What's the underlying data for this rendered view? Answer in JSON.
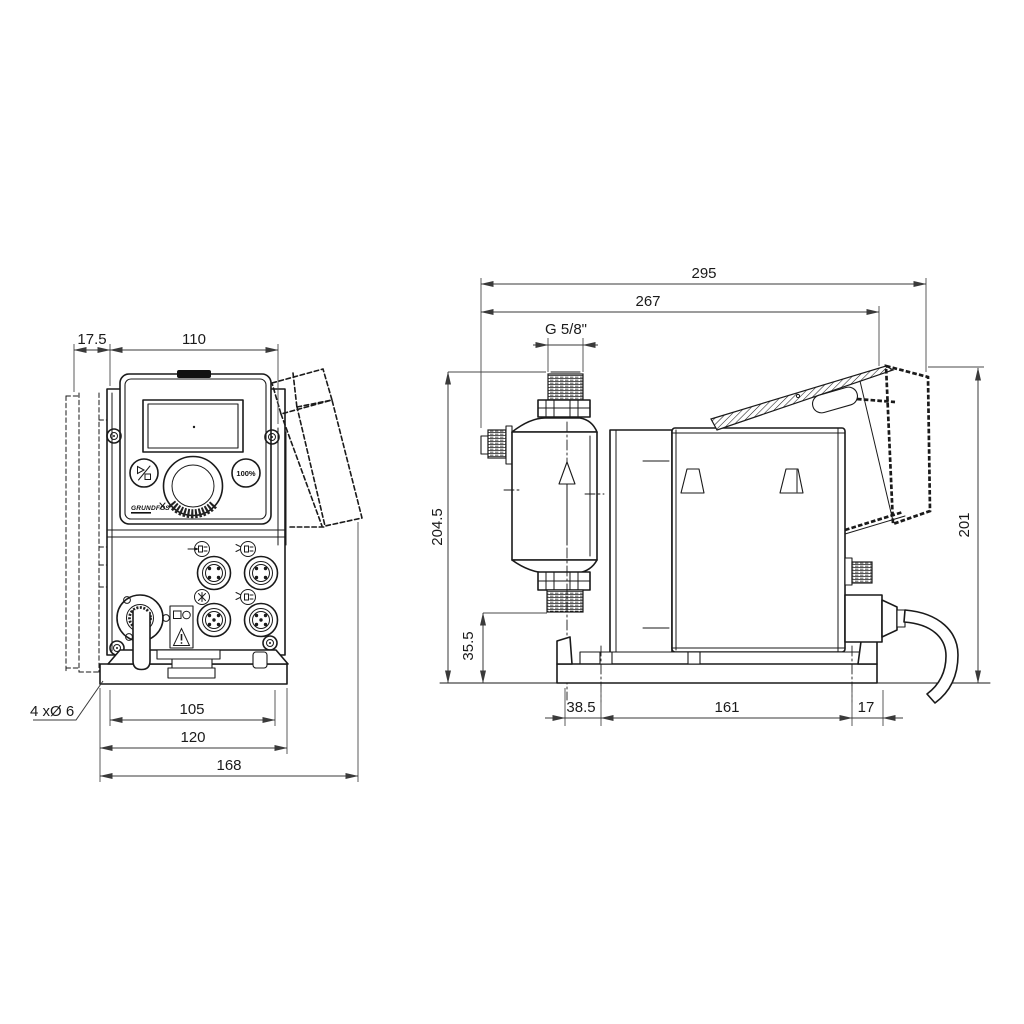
{
  "drawing_type": "dimensional technical drawing, two orthographic views of a dosing pump",
  "colors": {
    "ink": "#1a1a1a",
    "dimension": "#3a3a3a",
    "background": "#ffffff"
  },
  "front_view": {
    "dimensions": {
      "wall_offset": "17.5",
      "control_panel_width": "110",
      "mount_hole_spacing": "105",
      "base_plate_width": "120",
      "overall_width": "168"
    },
    "mounting_holes_label": "4 xØ 6",
    "control_panel": {
      "logo": "GRUNDFOS",
      "capacity_button_label": "100%"
    }
  },
  "side_view": {
    "dimensions": {
      "overall_depth": "295",
      "depth_without_cable": "267",
      "connection_thread": "G 5/8\"",
      "overall_height": "204.5",
      "outlet_valve_height": "35.5",
      "valve_to_front_hole": "38.5",
      "base_hole_spacing": "161",
      "hole_to_rear_edge": "17",
      "hood_height": "201"
    }
  },
  "icon_legend": {
    "start_stop_icon": "▷/□",
    "capacity_icon": "100%",
    "warning_triangle_icon": "⚠",
    "flow_direction_icon": "↑",
    "connector_icon": "M12 round connector",
    "logo_mark_icon": "✕"
  }
}
